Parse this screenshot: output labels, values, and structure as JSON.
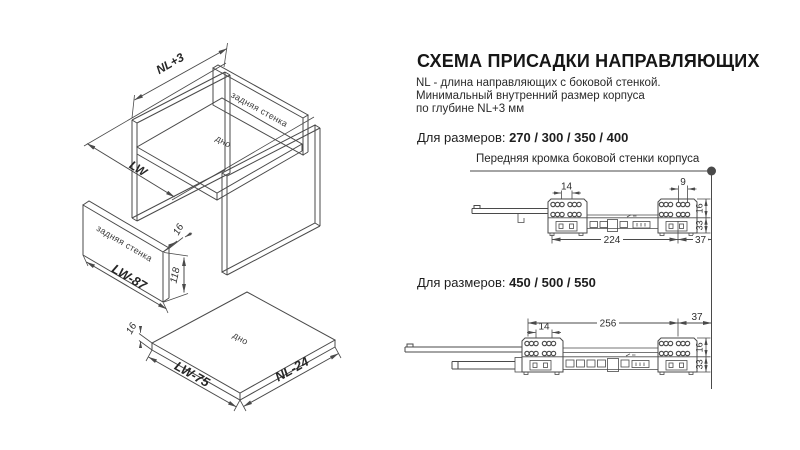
{
  "title": "СХЕМА ПРИСАДКИ НАПРАВЛЯЮЩИХ",
  "description": [
    "NL - длина направляющих с боковой стенкой.",
    "Минимальный внутренний размер корпуса",
    "по глубине NL+3 мм"
  ],
  "sections": {
    "small": {
      "label": "Для размеров: ",
      "sizes": "270 / 300 / 350 / 400"
    },
    "large": {
      "label": "Для размеров: ",
      "sizes": "450 / 500 / 550"
    }
  },
  "callout": "Передняя кромка боковой стенки корпуса",
  "dims_small": {
    "pitch": "14",
    "edge": "9",
    "length": "224",
    "front": "37",
    "h1": "16",
    "h2": "33"
  },
  "dims_large": {
    "pitch": "14",
    "length": "256",
    "front": "37",
    "h1": "16",
    "h2": "33"
  },
  "iso": {
    "depth": "NL+3",
    "width": "LW",
    "back_label": "задняя стенка",
    "bottom_label": "дно",
    "back_exploded_label": "задняя стенка",
    "bottom_exploded_label": "дно",
    "back_width": "LW-87",
    "back_height": "118",
    "back_thickness": "16",
    "bottom_width": "LW-75",
    "bottom_depth": "NL-24",
    "bottom_thickness": "16"
  },
  "colors": {
    "line": "#4a4a4a",
    "text": "#1c1c1c"
  }
}
